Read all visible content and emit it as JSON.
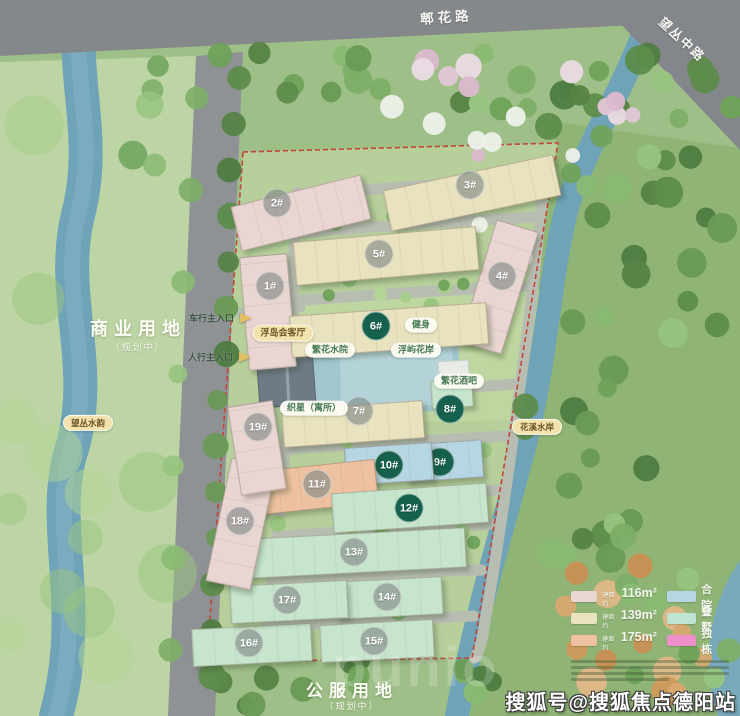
{
  "roads": {
    "top": "郫花路",
    "right": "望丛中路"
  },
  "areas": {
    "commercial_title": "商业用地",
    "commercial_sub": "（规划中）",
    "public_title": "公服用地",
    "public_sub": "（规划中）"
  },
  "map": {
    "water_badges": [
      {
        "text": "望丛水韵",
        "x": 88,
        "y": 423
      },
      {
        "text": "花溪水岸",
        "x": 537,
        "y": 427
      }
    ],
    "entrances": [
      {
        "label": "车行主入口",
        "x": 234,
        "y": 318,
        "ax": 240,
        "ay": 318
      },
      {
        "label": "人行主入口",
        "x": 233,
        "y": 357,
        "ax": 239,
        "ay": 357
      }
    ],
    "amenities": [
      {
        "text": "浮岛会客厅",
        "style": "yellow",
        "x": 283,
        "y": 333
      },
      {
        "text": "繁花水院",
        "style": "white",
        "x": 330,
        "y": 350
      },
      {
        "text": "健身",
        "style": "white",
        "x": 421,
        "y": 325
      },
      {
        "text": "浮屿花岸",
        "style": "white",
        "x": 416,
        "y": 350
      },
      {
        "text": "繁花酒吧",
        "style": "white",
        "x": 459,
        "y": 381
      },
      {
        "text": "织星（寓所）",
        "style": "white",
        "x": 314,
        "y": 408
      }
    ],
    "buildings": [
      {
        "label": "1#",
        "color": "pink",
        "x": 268,
        "y": 312,
        "w": 46,
        "h": 112,
        "rot": -5,
        "badge": "gray",
        "bx": 270,
        "by": 286
      },
      {
        "label": "2#",
        "color": "pink",
        "x": 301,
        "y": 213,
        "w": 132,
        "h": 44,
        "rot": -14,
        "badge": "gray",
        "bx": 277,
        "by": 203
      },
      {
        "label": "3#",
        "color": "cream",
        "x": 472,
        "y": 193,
        "w": 172,
        "h": 40,
        "rot": -12,
        "badge": "gray",
        "bx": 470,
        "by": 185
      },
      {
        "label": "4#",
        "color": "pink",
        "x": 499,
        "y": 287,
        "w": 42,
        "h": 126,
        "rot": 17,
        "badge": "gray",
        "bx": 502,
        "by": 276
      },
      {
        "label": "5#",
        "color": "cream",
        "x": 386,
        "y": 256,
        "w": 182,
        "h": 42,
        "rot": -5,
        "badge": "gray",
        "bx": 379,
        "by": 254
      },
      {
        "label": "6#",
        "color": "cream",
        "x": 389,
        "y": 330,
        "w": 196,
        "h": 40,
        "rot": -4,
        "badge": "green",
        "bx": 376,
        "by": 326
      },
      {
        "label": "7#",
        "color": "cream",
        "x": 353,
        "y": 424,
        "w": 140,
        "h": 36,
        "rot": -4,
        "badge": "gray",
        "bx": 359,
        "by": 411
      },
      {
        "label": "8#",
        "color": "mint",
        "x": 452,
        "y": 394,
        "w": 40,
        "h": 26,
        "rot": -4,
        "badge": "green",
        "bx": 450,
        "by": 409
      },
      {
        "label": "9#",
        "color": "blue",
        "x": 444,
        "y": 461,
        "w": 76,
        "h": 36,
        "rot": -4,
        "badge": "green",
        "bx": 440,
        "by": 462
      },
      {
        "label": "10#",
        "color": "blue",
        "x": 389,
        "y": 464,
        "w": 86,
        "h": 36,
        "rot": -4,
        "badge": "green",
        "bx": 389,
        "by": 465
      },
      {
        "label": "11#",
        "color": "salmon",
        "x": 317,
        "y": 487,
        "w": 118,
        "h": 42,
        "rot": -6,
        "badge": "gray",
        "bx": 317,
        "by": 484
      },
      {
        "label": "12#",
        "color": "mint",
        "x": 410,
        "y": 508,
        "w": 154,
        "h": 38,
        "rot": -4,
        "badge": "green",
        "bx": 409,
        "by": 508
      },
      {
        "label": "13#",
        "color": "mint",
        "x": 358,
        "y": 553,
        "w": 214,
        "h": 38,
        "rot": -3,
        "badge": "gray",
        "bx": 354,
        "by": 552
      },
      {
        "label": "14#",
        "color": "mint",
        "x": 389,
        "y": 598,
        "w": 106,
        "h": 36,
        "rot": -3,
        "badge": "gray",
        "bx": 387,
        "by": 597
      },
      {
        "label": "15#",
        "color": "mint",
        "x": 377,
        "y": 641,
        "w": 112,
        "h": 36,
        "rot": -3,
        "badge": "gray",
        "bx": 374,
        "by": 641
      },
      {
        "label": "16#",
        "color": "mint",
        "x": 252,
        "y": 645,
        "w": 118,
        "h": 36,
        "rot": -3,
        "badge": "gray",
        "bx": 249,
        "by": 643
      },
      {
        "label": "17#",
        "color": "mint",
        "x": 289,
        "y": 602,
        "w": 116,
        "h": 36,
        "rot": -3,
        "badge": "gray",
        "bx": 287,
        "by": 600
      },
      {
        "label": "18#",
        "color": "pink",
        "x": 241,
        "y": 524,
        "w": 44,
        "h": 124,
        "rot": 12,
        "badge": "gray",
        "bx": 240,
        "by": 521
      },
      {
        "label": "19#",
        "color": "pink",
        "x": 257,
        "y": 448,
        "w": 44,
        "h": 88,
        "rot": -9,
        "badge": "gray",
        "bx": 258,
        "by": 427
      }
    ]
  },
  "legend": {
    "size_items": [
      {
        "prefix": "建面约",
        "value": "116m²",
        "color": "pink"
      },
      {
        "prefix": "建面约",
        "value": "139m²",
        "color": "cream"
      },
      {
        "prefix": "建面约",
        "value": "175m²",
        "color": "salmon"
      }
    ],
    "type_items": [
      {
        "label": "合院",
        "color": "blue"
      },
      {
        "label": "叠墅",
        "color": "teal"
      },
      {
        "label": "独栋",
        "color": "magenta"
      }
    ]
  },
  "colors": {
    "pink": "#e9d5d1",
    "cream": "#e9e2bf",
    "salmon": "#eec2a0",
    "blue": "#b7d6e3",
    "mint": "#c7e5cc",
    "teal": "#bfe4d2",
    "magenta": "#ee8fc9",
    "badge_green": "#15614d",
    "river": "#6fa3b8",
    "boundary_red": "#c2453a"
  },
  "watermarks": {
    "bottom_right": "搜狐号@搜狐焦点德阳站",
    "center": "punio"
  }
}
